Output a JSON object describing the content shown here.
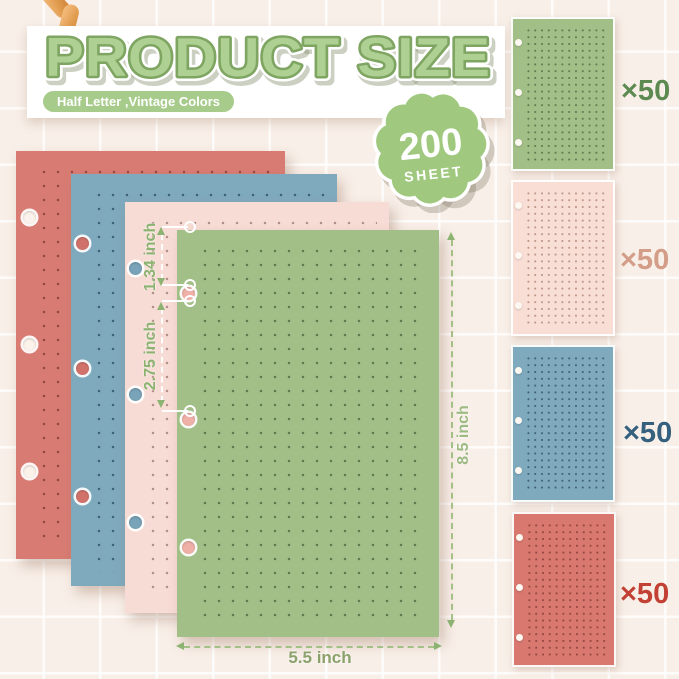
{
  "header": {
    "title": "PRODUCT SIZE",
    "subtitle": "Half Letter ,Vintage Colors"
  },
  "badge": {
    "count": "200",
    "unit": "SHEET"
  },
  "measurements": {
    "hole_top_offset": "1.34 inch",
    "hole_spacing": "2.75 inch",
    "sheet_height": "8.5 inch",
    "sheet_width": "5.5 inch"
  },
  "stack": {
    "sheets": [
      {
        "name": "coral",
        "hex": "#d87c73"
      },
      {
        "name": "blue",
        "hex": "#7fa9bd"
      },
      {
        "name": "pink",
        "hex": "#f7dcd5"
      },
      {
        "name": "green",
        "hex": "#a2bf88"
      }
    ]
  },
  "swatches": [
    {
      "name": "green",
      "hex": "#a2bf88",
      "count": "×50",
      "count_color": "#5c8a50"
    },
    {
      "name": "pink",
      "hex": "#f8ded5",
      "count": "×50",
      "count_color": "#d39d88"
    },
    {
      "name": "blue",
      "hex": "#7fa9bd",
      "count": "×50",
      "count_color": "#35617f"
    },
    {
      "name": "red",
      "hex": "#d8786e",
      "count": "×50",
      "count_color": "#c24134"
    }
  ],
  "colors": {
    "title_fill": "#aed092",
    "title_outline": "#7fa562",
    "pill_green": "#a7cb8b",
    "badge_green": "#a0c97f",
    "dimension_green": "#8cb371",
    "background": "#f8efe8"
  }
}
